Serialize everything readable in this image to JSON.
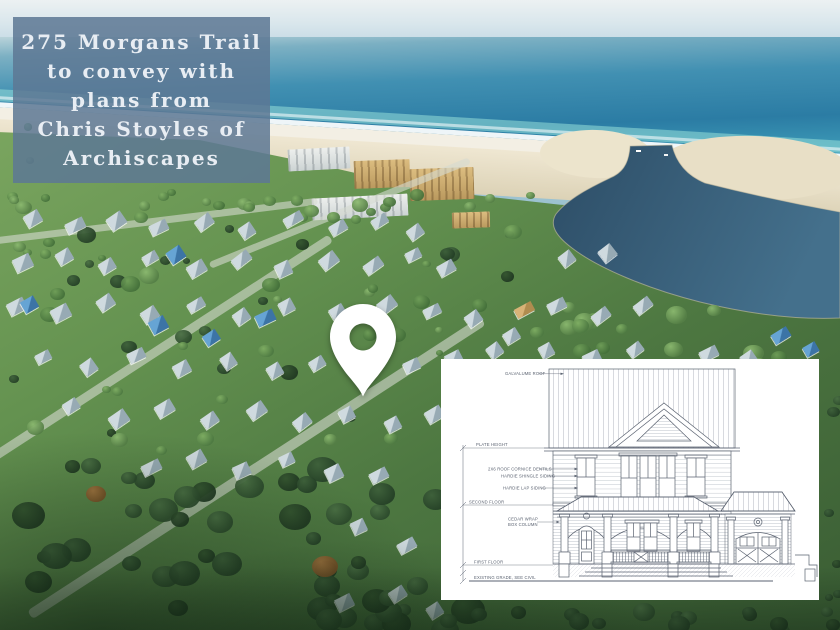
{
  "caption": {
    "lines": [
      "275 Morgans Trail",
      "to convey with",
      "plans from",
      "Chris Stoyles of",
      "Archiscapes"
    ]
  },
  "elevation": {
    "labels": {
      "roof": "GALVALUME ROOF",
      "plate_height": "PLATE HEIGHT",
      "dentils": "2X6 ROOF CORNICE DENTILS",
      "shingle": "HARDIE SHINGLE SIDING",
      "lap": "HARDIE LAP SIDING",
      "second_floor": "SECOND FLOOR",
      "column_line1": "CEDAR WRAP",
      "column_line2": "BOX COLUMN",
      "first_floor": "FIRST FLOOR",
      "grade": "EXISTING GRADE, SEE CIVIL"
    }
  },
  "colors": {
    "caption_bg": "#5d7894",
    "caption_text": "#e8edf3",
    "pin": "#ffffff",
    "drawing_ink": "#5a6270",
    "ocean": "#2b7ca4",
    "lake": "#2d4d66",
    "sand": "#efe7d2",
    "foliage": "#4d7741"
  }
}
